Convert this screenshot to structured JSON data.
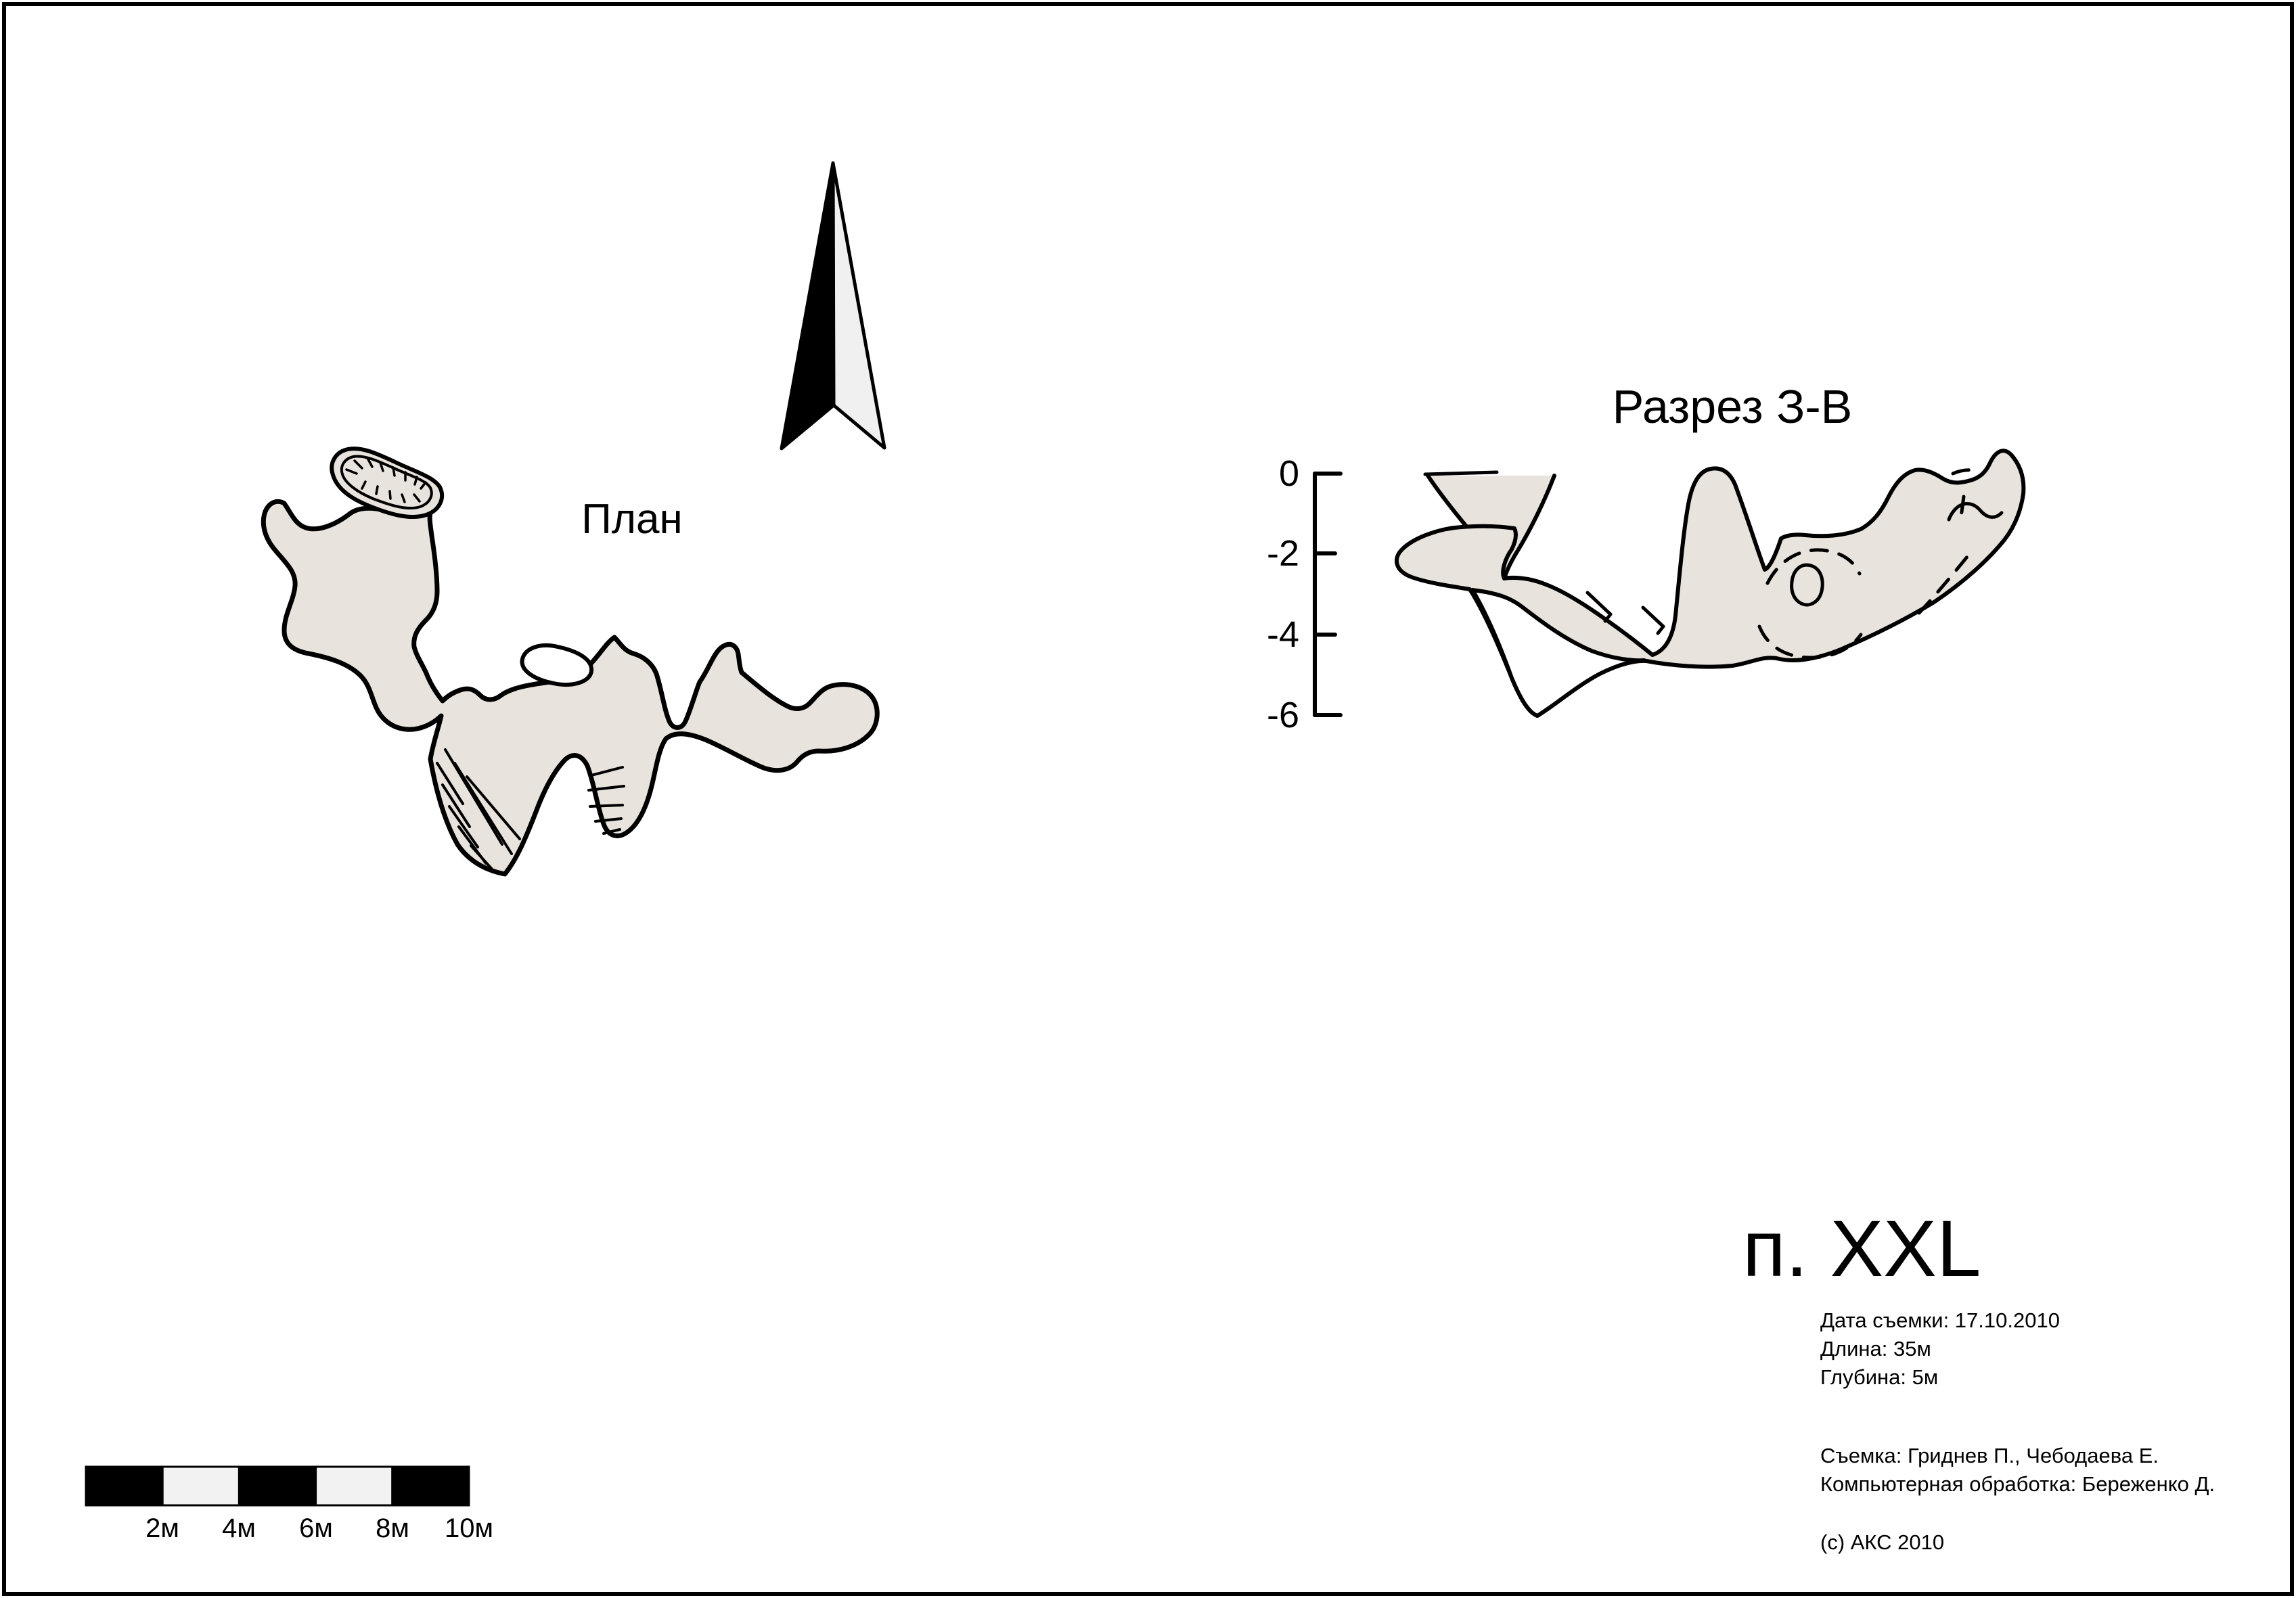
{
  "page": {
    "background": "#ffffff",
    "border_color": "#000000"
  },
  "colors": {
    "cave_fill": "#e9e3dd",
    "outline": "#000000",
    "north_arrow_light": "#f0f0f0",
    "scale_bar_light": "#f2f2f2"
  },
  "plan": {
    "title": "План"
  },
  "section": {
    "title": "Разрез З-В",
    "depth_ticks": [
      {
        "label": "0"
      },
      {
        "label": "-2"
      },
      {
        "label": "-4"
      },
      {
        "label": "-6"
      }
    ]
  },
  "title_block": {
    "cave_name": "п. XXL",
    "survey_date": "Дата съемки: 17.10.2010",
    "length": "Длина: 35м",
    "depth": "Глубина: 5м",
    "surveyors": "Съемка: Гриднев П., Чебодаева Е.",
    "processing": "Компьютерная обработка: Береженко Д.",
    "copyright": "(c) АКС 2010"
  },
  "scale_bar": {
    "labels": [
      "2м",
      "4м",
      "6м",
      "8м",
      "10м"
    ]
  }
}
